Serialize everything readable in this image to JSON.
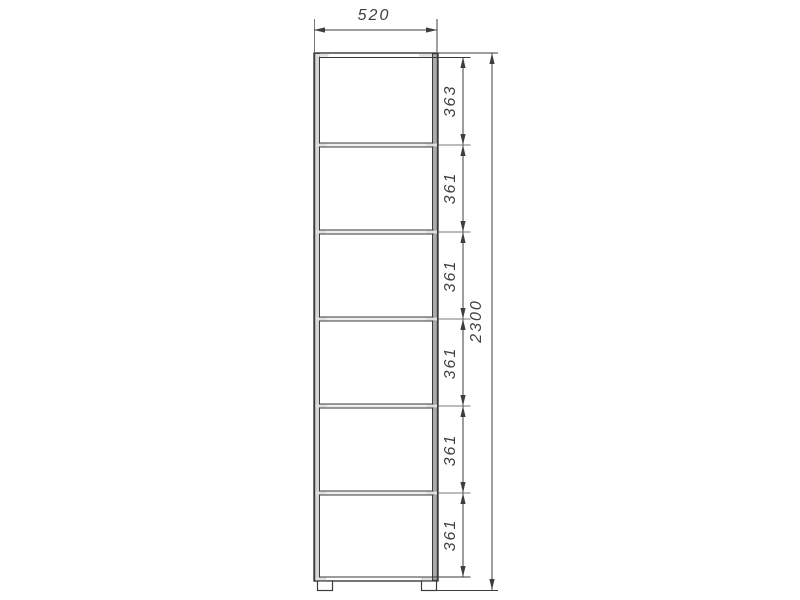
{
  "dimensions": {
    "width": "520",
    "total_height": "2300",
    "segments": [
      "363",
      "361",
      "361",
      "361",
      "361",
      "361"
    ]
  },
  "colors": {
    "background": "#ffffff",
    "cabinet_outline": "#3a3a3a",
    "dimension_line": "#3d3d3d",
    "extension_line": "#787878",
    "panel_fill_left": "#d6d6d6",
    "panel_fill_right": "#ababab",
    "shelf_fill": "#efefef",
    "notch_fill": "#e0e0e0"
  }
}
